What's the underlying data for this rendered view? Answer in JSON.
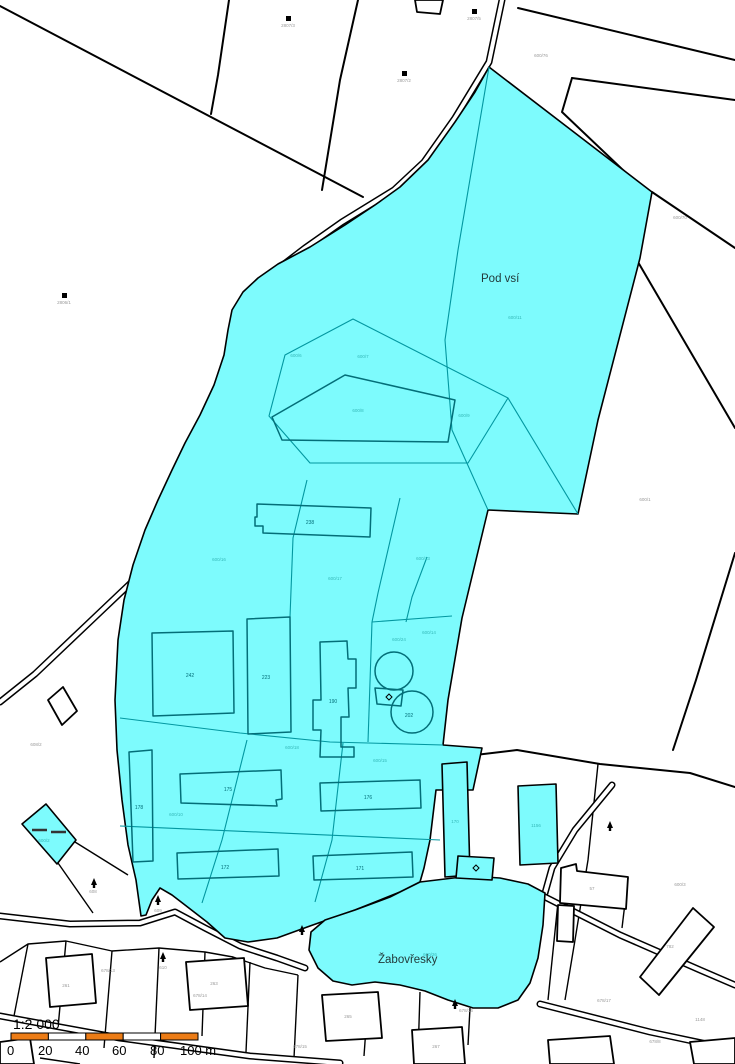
{
  "map": {
    "title": "cadastral-map",
    "region_labels": [
      {
        "text": "Pod vsí"
      },
      {
        "text": "Žabovřesky"
      }
    ],
    "parcel_labels": [
      {
        "text": "2807/3"
      },
      {
        "text": "2807/2"
      },
      {
        "text": "2807/5"
      },
      {
        "text": "600/76"
      },
      {
        "text": "600/1"
      },
      {
        "text": "2806/1"
      },
      {
        "text": "608"
      },
      {
        "text": "609"
      },
      {
        "text": "610"
      },
      {
        "text": "600/3"
      },
      {
        "text": "782"
      },
      {
        "text": "1148"
      },
      {
        "text": "678/8"
      },
      {
        "text": "678/13"
      },
      {
        "text": "678/14"
      },
      {
        "text": "678/15"
      },
      {
        "text": "678/16"
      },
      {
        "text": "678/17"
      },
      {
        "text": "261"
      },
      {
        "text": "263"
      },
      {
        "text": "265"
      },
      {
        "text": "267"
      },
      {
        "text": "57"
      },
      {
        "text": "608/2"
      },
      {
        "text": "600/70"
      },
      {
        "text": "600/11"
      },
      {
        "text": "600/6"
      },
      {
        "text": "600/7"
      },
      {
        "text": "600/8"
      },
      {
        "text": "600/9"
      },
      {
        "text": "600/16"
      },
      {
        "text": "600/17"
      },
      {
        "text": "600/13"
      },
      {
        "text": "600/14"
      },
      {
        "text": "600/18"
      },
      {
        "text": "600/10"
      },
      {
        "text": "600/15"
      },
      {
        "text": "600/24"
      },
      {
        "text": "600/26"
      },
      {
        "text": "600/2"
      },
      {
        "text": "1156"
      },
      {
        "text": "170"
      },
      {
        "text": "238"
      },
      {
        "text": "242"
      },
      {
        "text": "223"
      },
      {
        "text": "190"
      },
      {
        "text": "202"
      },
      {
        "text": "178"
      },
      {
        "text": "175"
      },
      {
        "text": "176"
      },
      {
        "text": "172"
      },
      {
        "text": "171"
      }
    ],
    "scalebar": {
      "ratio": "1:2 000",
      "ticks": [
        "0",
        "20",
        "40",
        "60",
        "80",
        "100 m"
      ]
    }
  },
  "colors": {
    "background": "#FFFFFF",
    "highlight_fill": "#7DFBFD",
    "inner_line": "#0397A0",
    "building_line": "#036E78",
    "outline": "#000000",
    "scalebar_orange": "#EC7C16",
    "label_inside": "#35b8b8",
    "label_outside": "#999999",
    "region_label": "#223a3a"
  }
}
